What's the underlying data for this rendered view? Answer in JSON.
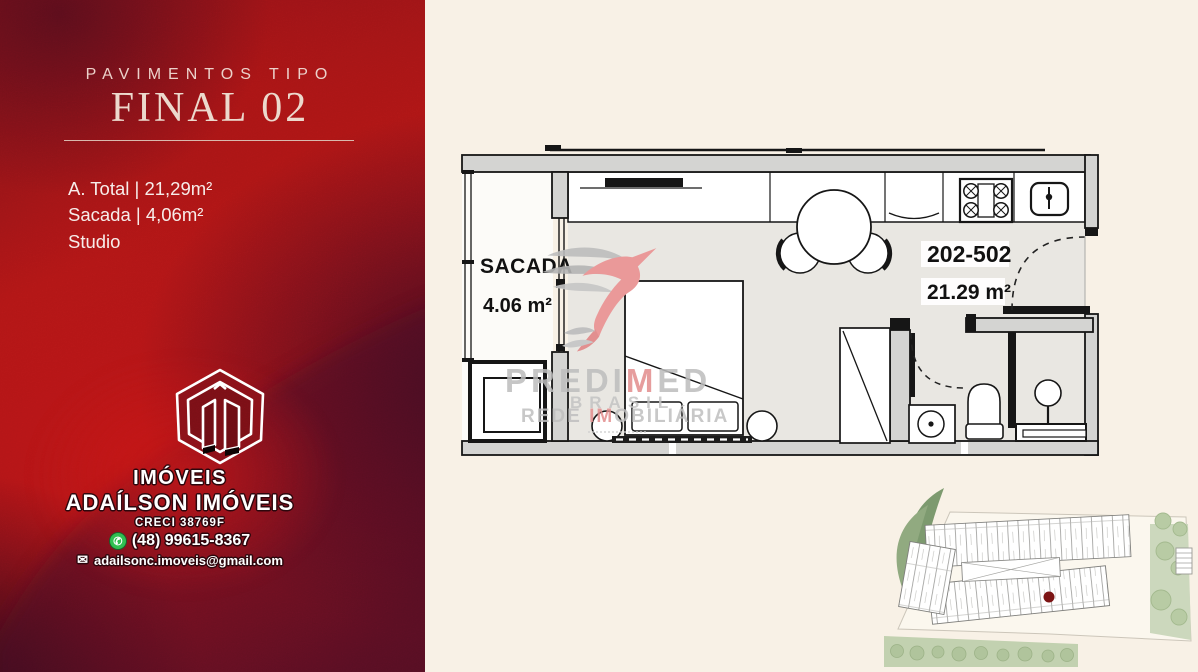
{
  "page": {
    "background": "#f8f1e6"
  },
  "left_panel": {
    "eyebrow": "PAVIMENTOS TIPO",
    "title": "FINAL 02",
    "specs": [
      "A. Total | 21,29m²",
      "Sacada | 4,06m²",
      "Studio"
    ],
    "colors": {
      "bright_red": "#ab1616",
      "dark_maroon": "#44102a"
    },
    "agency": {
      "logo_word": "IMÓVEIS",
      "name": "ADAÍLSON IMÓVEIS",
      "creci": "CRECI 38769F",
      "phone": "(48) 99615-8367",
      "email": "adailsonc.imoveis@gmail.com"
    }
  },
  "floor_plan": {
    "balcony_label": "SACADA",
    "balcony_area": "4.06 m²",
    "unit_range": "202-502",
    "unit_area": "21.29 m²"
  },
  "watermark": {
    "brand_prefix": "PREDI",
    "brand_accent": "M",
    "brand_suffix": "ED",
    "country": "BRASIL",
    "tagline_prefix": "REDE ",
    "tagline_accent": "IM",
    "tagline_suffix": "OBILIÁRIA",
    "gray": "#bdbdbd",
    "pink": "#e28d8d"
  },
  "site_plan": {
    "marker_color": "#7c1414"
  }
}
